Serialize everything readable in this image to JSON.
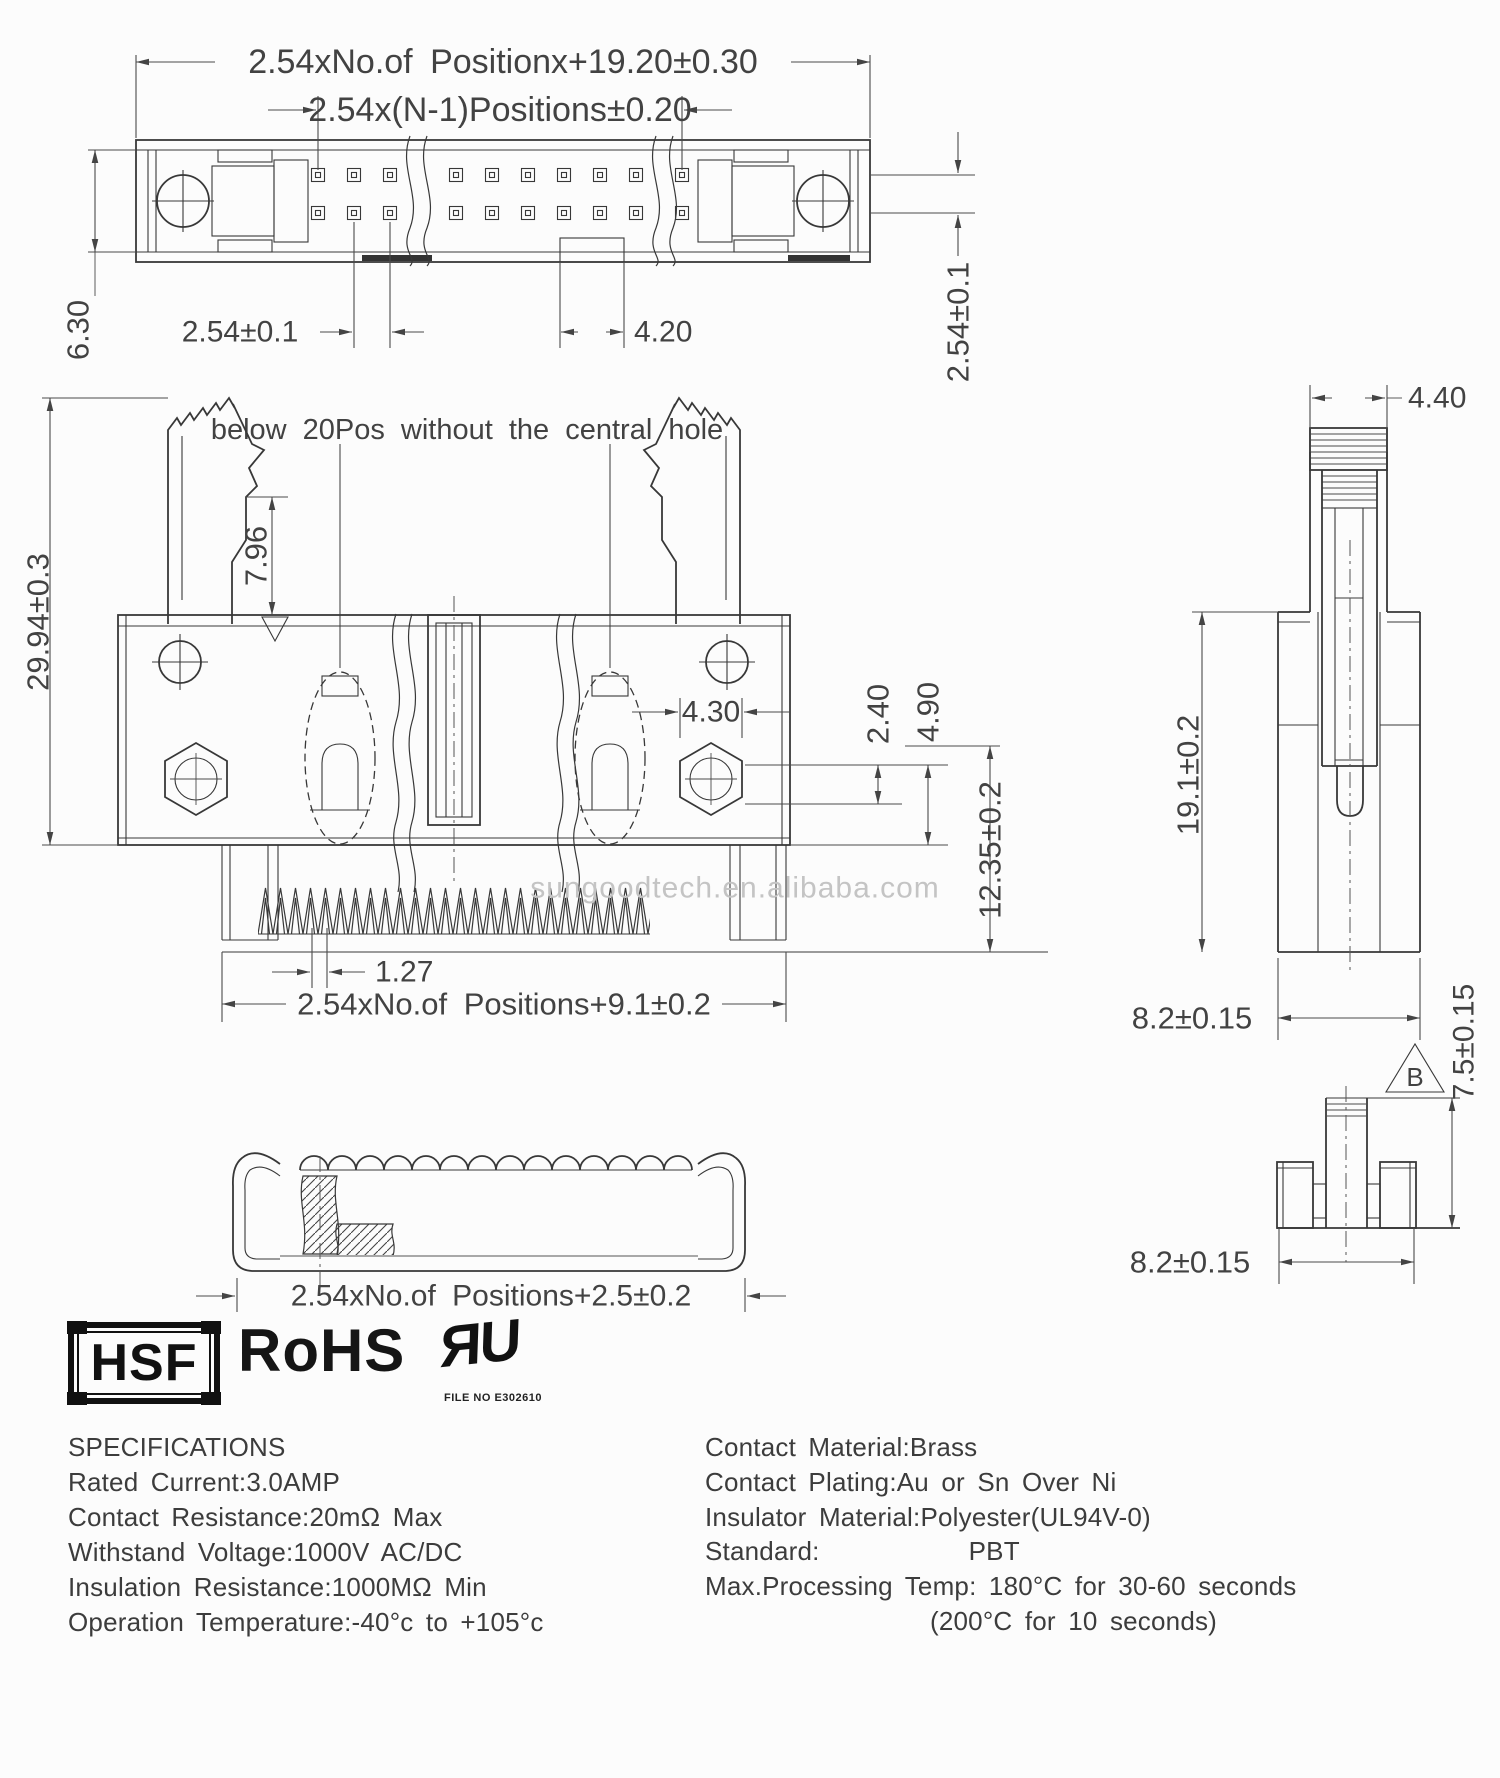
{
  "watermark": "sungoodtech.en.alibaba.com",
  "note": "below 20Pos without the central hole",
  "top_view": {
    "dim_overall": "2.54xNo.of Positionx+19.20±0.30",
    "dim_pin_span": "2.54x(N-1)Positions±0.20",
    "dim_height": "6.30",
    "dim_pitch": "2.54±0.1",
    "dim_key_width": "4.20",
    "dim_row_pitch": "2.54±0.1"
  },
  "front_view": {
    "dim_total_height": "29.94±0.3",
    "dim_latch": "7.96",
    "dim_boss_width": "4.30",
    "dim_boss_height": "2.40",
    "dim_standoff": "4.90",
    "dim_pin_length": "12.35±0.2",
    "dim_tooth_pitch": "1.27",
    "dim_body_width": "2.54xNo.of Positions+9.1±0.2"
  },
  "side_view": {
    "dim_latch_width": "4.40",
    "dim_height": "19.1±0.2",
    "dim_depth": "8.2±0.15"
  },
  "end_view": {
    "datum_label": "B",
    "dim_height": "7.5±0.15",
    "dim_depth": "8.2±0.15"
  },
  "clamp_view": {
    "dim_width": "2.54xNo.of Positions+2.5±0.2"
  },
  "certifications": {
    "hsf": "HSF",
    "rohs": "RoHS",
    "ul_mark": "ЯU",
    "ul_file": "FILE NO E302610"
  },
  "specifications": {
    "title": "SPECIFICATIONS",
    "lines": [
      "Rated Current:3.0AMP",
      "Contact Resistance:20mΩ Max",
      "Withstand Voltage:1000V AC/DC",
      "Insulation Resistance:1000MΩ Min",
      "Operation Temperature:-40°c to +105°c"
    ]
  },
  "materials": {
    "lines": [
      "Contact Material:Brass",
      "Contact Plating:Au or Sn Over Ni",
      "Insulator Material:Polyester(UL94V-0)",
      "Standard:            PBT",
      "Max.Processing Temp: 180°C for 30-60 seconds",
      "(200°C for 10 seconds)"
    ]
  }
}
